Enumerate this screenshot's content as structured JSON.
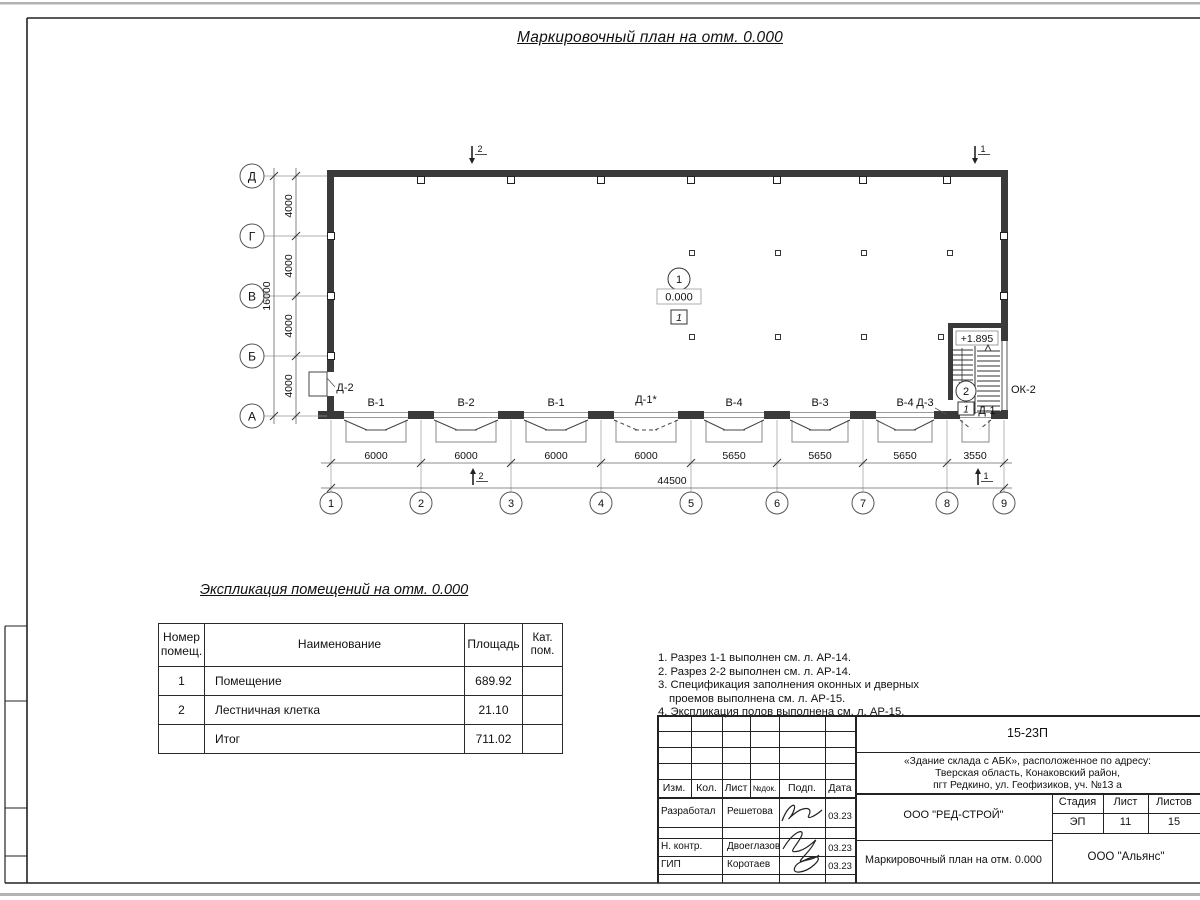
{
  "page": {
    "main_title": "Маркировочный план на отм. 0.000",
    "table_title": "Экспликация помещений на отм. 0.000"
  },
  "plan": {
    "axes_bottom": [
      "1",
      "2",
      "3",
      "4",
      "5",
      "6",
      "7",
      "8",
      "9"
    ],
    "axes_left": [
      "Д",
      "Г",
      "В",
      "Б",
      "А"
    ],
    "dims_bottom": [
      "6000",
      "6000",
      "6000",
      "6000",
      "5650",
      "5650",
      "5650",
      "3550"
    ],
    "total_bottom": "44500",
    "dims_left": [
      "4000",
      "4000",
      "4000",
      "4000"
    ],
    "total_left": "16000",
    "openings": [
      "В-1",
      "В-2",
      "В-1",
      "Д-1*",
      "В-4",
      "В-3",
      "В-4"
    ],
    "door_d2": "Д-2",
    "door_d3": "Д-3",
    "door_d1": "Д-1",
    "window_ok2": "ОК-2",
    "room1_number": "1",
    "room1_elevation": "0.000",
    "room1_floor": "1",
    "stair_elevation": "+1.895",
    "stair_number": "2",
    "stair_floor": "1",
    "section_mark_1": "1",
    "section_mark_2": "2"
  },
  "table": {
    "h_num1": "Номер",
    "h_num2": "помещ.",
    "h_name": "Наименование",
    "h_area": "Площадь",
    "h_cat1": "Кат.",
    "h_cat2": "пом.",
    "rows": [
      {
        "num": "1",
        "name": "Помещение",
        "area": "689.92",
        "cat": ""
      },
      {
        "num": "2",
        "name": "Лестничная клетка",
        "area": "21.10",
        "cat": ""
      },
      {
        "num": "",
        "name": "Итог",
        "area": "711.02",
        "cat": ""
      }
    ]
  },
  "notes": {
    "l1": "1. Разрез 1-1 выполнен см. л. АР-14.",
    "l2": "2. Разрез 2-2 выполнен см. л. АР-14.",
    "l3": "3. Спецификация заполнения оконных и дверных",
    "l4": "проемов выполнена см. л. АР-15.",
    "l5": "4. Экспликация полов выполнена см. л. АР-15."
  },
  "titleblock": {
    "doc_number": "15-23П",
    "address1": "«Здание склада с АБК», расположенное по адресу:",
    "address2": "Тверская область, Конаковский район,",
    "address3": "пгт Редкино, ул. Геофизиков, уч. №13 а",
    "col_izm": "Изм.",
    "col_kol": "Кол.",
    "col_list": "Лист",
    "col_ndok": "№док.",
    "col_podp": "Подп.",
    "col_data": "Дата",
    "row1_role": "Разработал",
    "row1_name": "Решетова",
    "row1_date": "03.23",
    "row2_role": "Н. контр.",
    "row2_name": "Двоеглазов",
    "row2_date": "03.23",
    "row3_role": "ГИП",
    "row3_name": "Коротаев",
    "row3_date": "03.23",
    "company": "ООО \"РЕД-СТРОЙ\"",
    "sheet_title": "Маркировочный план на отм. 0.000",
    "stage_label": "Стадия",
    "sheet_label": "Лист",
    "sheets_label": "Листов",
    "stage": "ЭП",
    "sheet": "11",
    "sheets": "15",
    "org": "ООО \"Альянс\""
  }
}
